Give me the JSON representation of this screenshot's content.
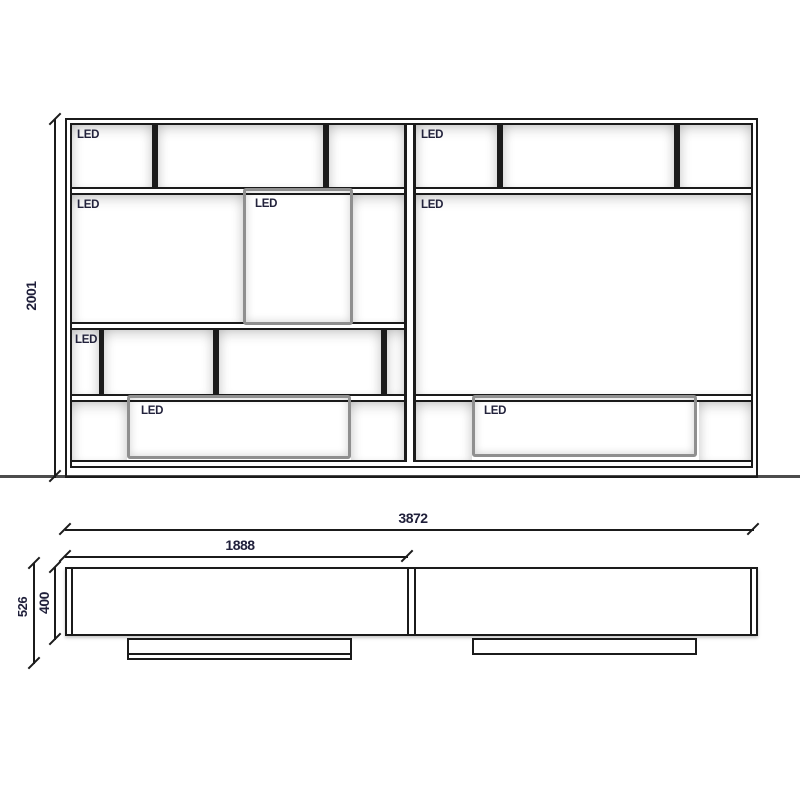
{
  "labels": {
    "led": "LED"
  },
  "dimensions": {
    "unit_height": "2001",
    "total_width": "3872",
    "left_section_width": "1888",
    "total_depth": "526",
    "cabinet_depth": "400"
  },
  "colors": {
    "line": "#1b1b1b",
    "ground_line": "#4c4c4c",
    "led_text": "#23233c",
    "dimension_text": "#1f1f3a",
    "led_box_frame": "#8f8f8f",
    "led_box_fill": "#f3f1e9",
    "background": "#ffffff"
  }
}
